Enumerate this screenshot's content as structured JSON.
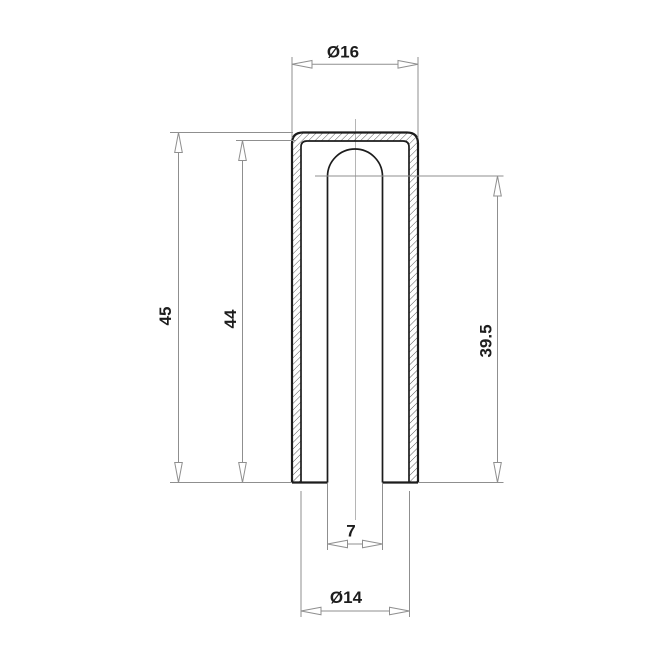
{
  "drawing": {
    "background": "#ffffff",
    "line_colors": {
      "outline": "#1c1c1c",
      "dimension": "#8f8f8f",
      "centerline": "#b5b5b5",
      "hatch": "#4a4a4a",
      "text": "#1d1d1d"
    },
    "dimensions": {
      "outer_diameter": {
        "label": "Ø16"
      },
      "overall_height": {
        "label": "45"
      },
      "inner_depth": {
        "label": "44"
      },
      "bore_depth": {
        "label": "39.5"
      },
      "bore_diameter": {
        "label": "7"
      },
      "inner_diameter": {
        "label": "Ø14"
      }
    }
  }
}
